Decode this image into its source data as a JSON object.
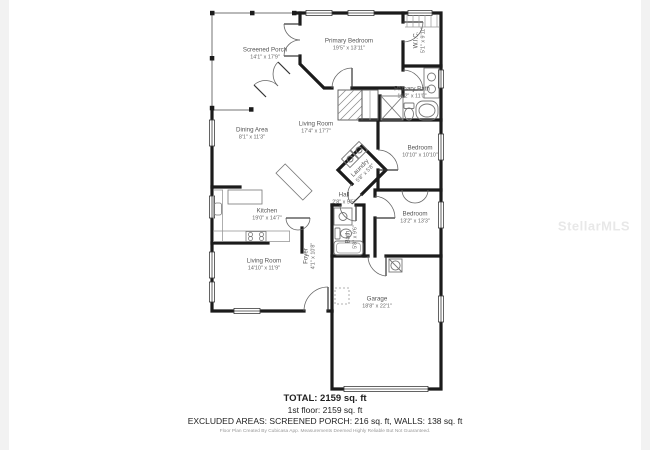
{
  "watermark": "StellarMLS",
  "rooms": [
    {
      "id": "screened-porch",
      "name": "Screened Porch",
      "dims": "14'1\" x 17'9\""
    },
    {
      "id": "primary-bedroom",
      "name": "Primary Bedroom",
      "dims": "19'5\" x 13'11\""
    },
    {
      "id": "wic",
      "name": "W.I.C.",
      "dims": "5'1\" x 9'11\""
    },
    {
      "id": "primary-bath",
      "name": "Primary Bath",
      "dims": "10'2\" x 11'0\""
    },
    {
      "id": "dining-area",
      "name": "Dining Area",
      "dims": "8'1\" x 11'3\""
    },
    {
      "id": "living-room",
      "name": "Living Room",
      "dims": "17'4\" x 17'7\""
    },
    {
      "id": "laundry",
      "name": "Laundry",
      "dims": "5'8\" x 5'8\""
    },
    {
      "id": "bedroom-1",
      "name": "Bedroom",
      "dims": "10'10\" x 10'10\""
    },
    {
      "id": "hall",
      "name": "Hall",
      "dims": "2'8\" x 5'5\""
    },
    {
      "id": "bedroom-2",
      "name": "Bedroom",
      "dims": "13'2\" x 13'3\""
    },
    {
      "id": "kitchen",
      "name": "Kitchen",
      "dims": "19'0\" x 14'7\""
    },
    {
      "id": "bath",
      "name": "Bath",
      "dims": "5'8\" x 9'6\""
    },
    {
      "id": "foyer",
      "name": "Foyer",
      "dims": "4'1\" x 10'8\""
    },
    {
      "id": "living-room-2",
      "name": "Living Room",
      "dims": "14'10\" x 11'9\""
    },
    {
      "id": "garage",
      "name": "Garage",
      "dims": "18'8\" x 22'1\""
    }
  ],
  "summary": {
    "total": "TOTAL: 2159 sq. ft",
    "floor1": "1st floor: 2159 sq. ft",
    "excluded": "EXCLUDED AREAS: SCREENED PORCH: 216 sq. ft, WALLS: 138 sq. ft",
    "disclaimer": "Floor Plan Created By Cubicasa App. Measurements Deemed Highly Reliable But Not Guaranteed."
  }
}
